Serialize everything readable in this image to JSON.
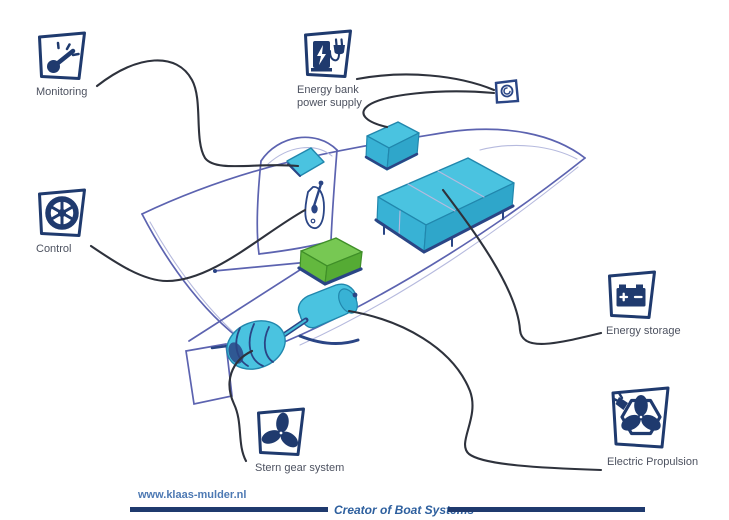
{
  "callouts": {
    "monitoring": {
      "label": "Monitoring",
      "icon": "gauge-icon"
    },
    "control": {
      "label": "Control",
      "icon": "helm-wheel-icon"
    },
    "energy_bank": {
      "label_line1": "Energy bank",
      "label_line2": "power supply",
      "icon": "charging-station-plug-icon"
    },
    "energy_storage": {
      "label": "Energy storage",
      "icon": "battery-icon"
    },
    "electric_propulsion": {
      "label": "Electric Propulsion",
      "icon": "propeller-hexagon-plug-icon"
    },
    "stern_gear": {
      "label": "Stern gear system",
      "icon": "propeller-icon"
    }
  },
  "sketch_parts": [
    "boat-hull",
    "cabin-console",
    "instrument-panel",
    "throttle-lever",
    "energy-bank-box",
    "battery-bank-box",
    "converter-box",
    "electric-motor",
    "shaft",
    "stern-gear-assembly",
    "rudder",
    "tiller",
    "shore-power-outlet"
  ],
  "footer": {
    "website": "www.klaas-mulder.nl",
    "tagline": "Creator of Boat Systems"
  },
  "colors": {
    "navy": "#1f3a6e",
    "label_text": "#4d5260",
    "cable": "#2e323c",
    "sketch": "#5c63b0",
    "sketch_light": "#b6bade",
    "cyan": "#4ac3e0",
    "cyan_front": "#38b2d5",
    "cyan_side": "#2fa6ca",
    "cyan_edge": "#2187ad",
    "shadow_navy": "#2a4585",
    "green_top": "#77c853",
    "green_front": "#63b83e",
    "green_side": "#55ab34",
    "green_edge": "#3f8f28",
    "link_blue": "#4d79b3",
    "tagline_blue": "#2d5f9e"
  }
}
